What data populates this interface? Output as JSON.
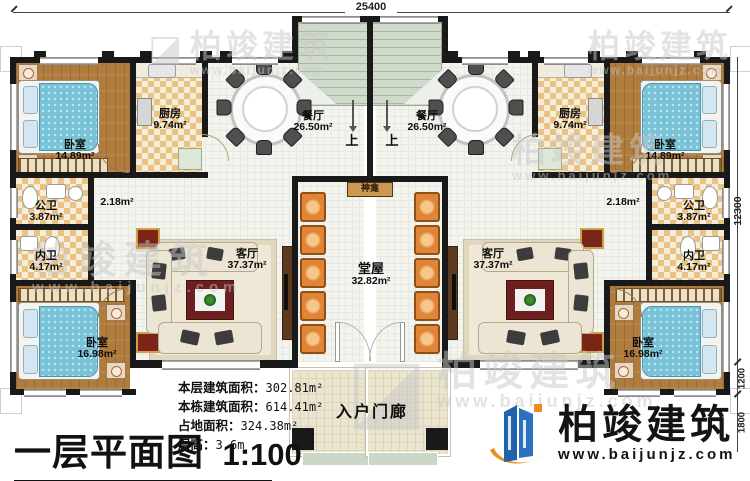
{
  "plan": {
    "dims": {
      "width_total": "25400",
      "height_main": "12300",
      "height_step": "1200",
      "height_porch": "1800"
    },
    "stair_up": "上",
    "rooms_left": {
      "bedroom_top": {
        "label": "卧室",
        "area": "14.89m²"
      },
      "kitchen": {
        "label": "厨房",
        "area": "9.74m²"
      },
      "dining": {
        "label": "餐厅",
        "area": "26.50m²"
      },
      "corridor": {
        "area": "2.18m²"
      },
      "public_bath": {
        "label": "公卫",
        "area": "3.87m²"
      },
      "private_bath": {
        "label": "内卫",
        "area": "4.17m²"
      },
      "bedroom_bottom": {
        "label": "卧室",
        "area": "16.98m²"
      },
      "living": {
        "label": "客厅",
        "area": "37.37m²"
      }
    },
    "rooms_right": {
      "bedroom_top": {
        "label": "卧室",
        "area": "14.89m²"
      },
      "kitchen": {
        "label": "厨房",
        "area": "9.74m²"
      },
      "dining": {
        "label": "餐厅",
        "area": "26.50m²"
      },
      "corridor": {
        "area": "2.18m²"
      },
      "public_bath": {
        "label": "公卫",
        "area": "3.87m²"
      },
      "private_bath": {
        "label": "内卫",
        "area": "4.17m²"
      },
      "bedroom_bottom": {
        "label": "卧室",
        "area": "16.98m²"
      },
      "living": {
        "label": "客厅",
        "area": "37.37m²"
      }
    },
    "hall": {
      "label": "堂屋",
      "area": "32.82m²"
    },
    "shrine": {
      "label": "神龛"
    },
    "porch": {
      "label": "入户门廊"
    }
  },
  "title_block": {
    "title": "一层平面图",
    "scale": "1:100"
  },
  "stats": [
    {
      "label": "本层建筑面积：",
      "value": "302.81m²"
    },
    {
      "label": "本栋建筑面积：",
      "value": "614.41m²"
    },
    {
      "label": "占地面积：",
      "value": "324.38m²"
    },
    {
      "label": "层高：",
      "value": "3.6m"
    }
  ],
  "logo": {
    "name": "柏竣建筑",
    "url": "www.baijunjz.com"
  },
  "watermark": {
    "name": "柏竣建筑",
    "url": "www.baijunjz.com"
  }
}
